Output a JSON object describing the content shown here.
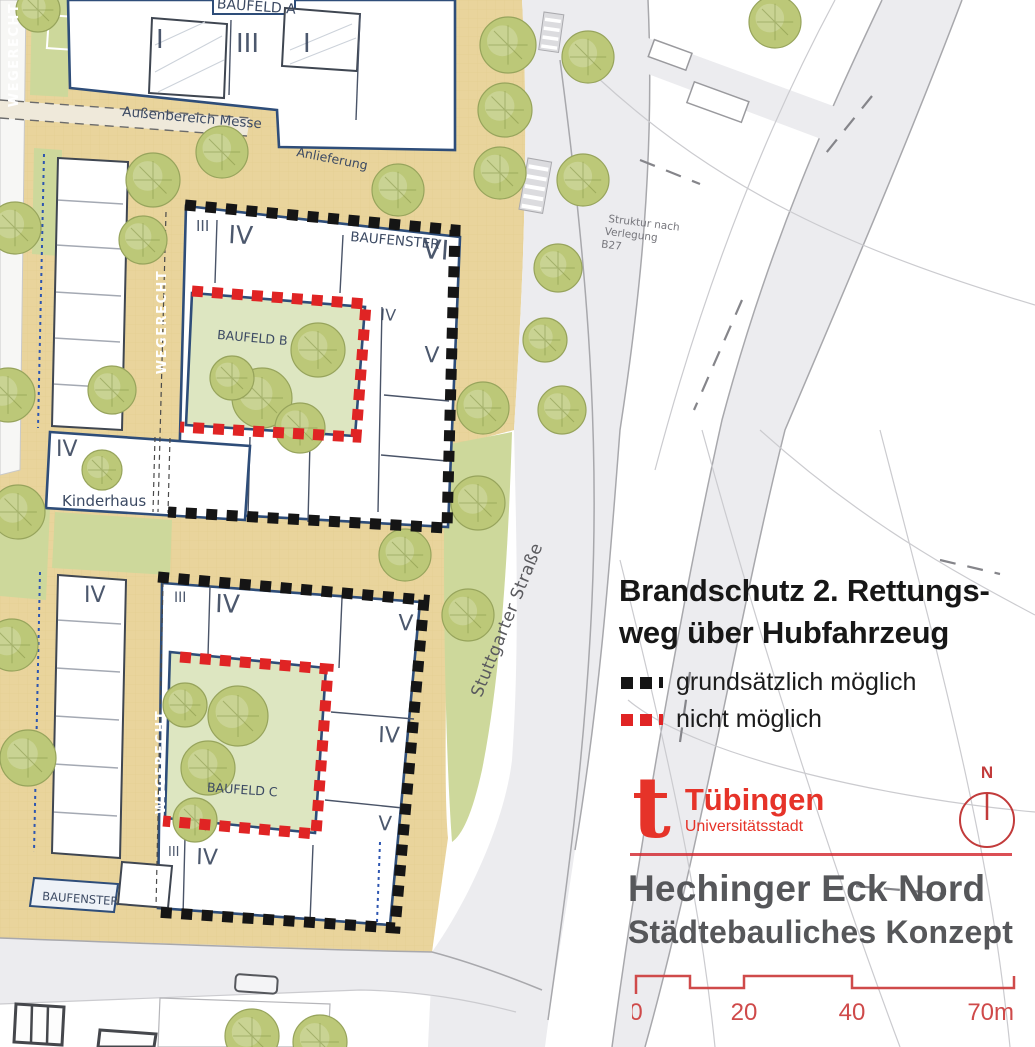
{
  "panel": {
    "heading_line1": "Brandschutz 2. Rettungs-",
    "heading_line2": "weg über Hubfahrzeug",
    "legend": {
      "possible_label": "grundsätzlich möglich",
      "not_possible_label": "nicht möglich"
    }
  },
  "branding": {
    "logo_t": "t",
    "city": "Tübingen",
    "city_subtitle": "Universitätsstadt",
    "north_label": "N",
    "project_title": "Hechinger Eck Nord",
    "project_subtitle": "Städtebauliches Konzept"
  },
  "scalebar": {
    "tick0": "0",
    "tick20": "20",
    "tick40": "40",
    "tick70": "70m"
  },
  "map_labels": {
    "baufeld_a": "BAUFELD A",
    "baufeld_b": "BAUFELD B",
    "baufeld_c": "BAUFELD C",
    "baufenster": "BAUFENSTER",
    "aussenbereich_messe": "Außenbereich Messe",
    "anlieferung": "Anlieferung",
    "kinderhaus": "Kinderhaus",
    "wegerecht": "WEGERECHT",
    "stuttgarter_strasse": "Stuttgarter Straße",
    "b27_line1": "Struktur nach",
    "b27_line2": "Verlegung",
    "b27_line3": "B27",
    "n1": "I",
    "n3": "III",
    "n4": "IV",
    "n5": "V",
    "n6": "VI"
  },
  "colors": {
    "accent_red": "#d2232a",
    "logo_red": "#e63329",
    "scale_red": "#cf4a4a",
    "dash_black": "#151515",
    "dash_red": "#e02424",
    "title_gray": "#56575a",
    "map_ground": "#e9d49c",
    "map_green": "#cdd89b",
    "courtyard_green": "#dde6c1",
    "tree_green": "#bcc878",
    "building_outline": "#2e4d79",
    "road_gray": "#ececef"
  }
}
